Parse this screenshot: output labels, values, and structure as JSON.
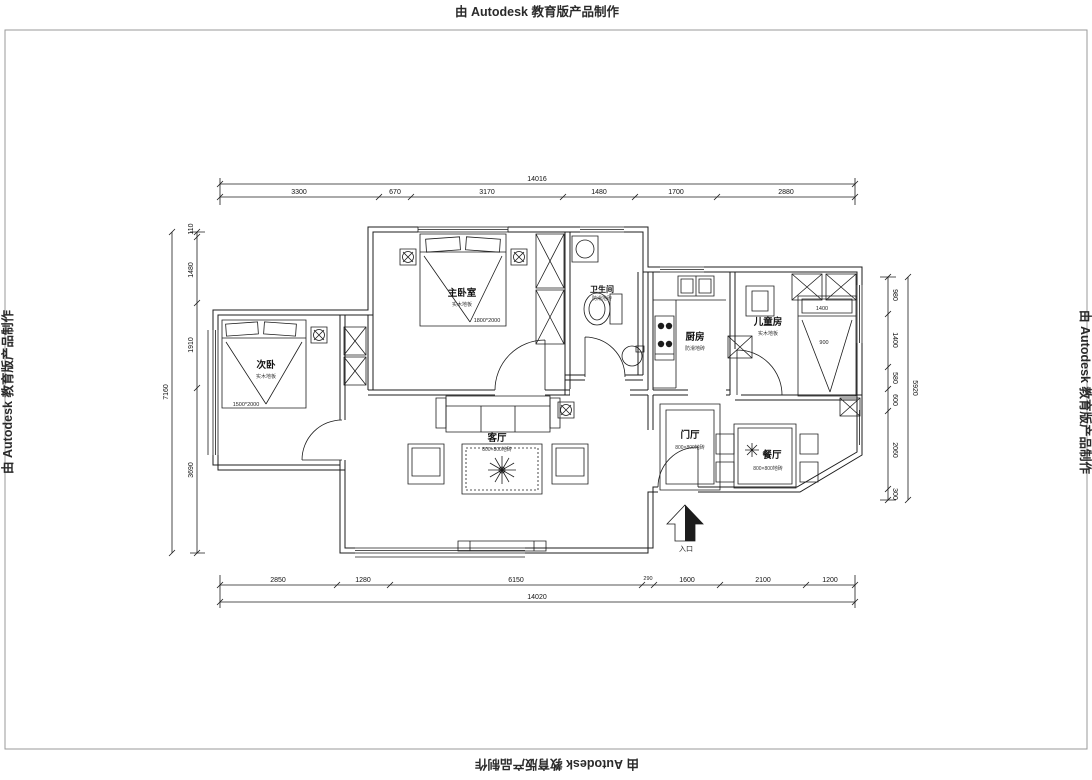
{
  "watermarks": {
    "top": "由 Autodesk 教育版产品制作",
    "bottom": "由 Autodesk 教育版产品制作",
    "left": "由 Autodesk 教育版产品制作",
    "right": "由 Autodesk 教育版产品制作"
  },
  "rooms": {
    "master": {
      "label": "主卧室",
      "note": "实木地板"
    },
    "second": {
      "label": "次卧",
      "note": "实木地板"
    },
    "bath": {
      "label": "卫生间",
      "note": "防滑地砖"
    },
    "kitchen": {
      "label": "厨房",
      "note": "防滑地砖"
    },
    "kids": {
      "label": "儿童房",
      "note": "实木地板"
    },
    "living": {
      "label": "客厅",
      "note": "800×800地砖"
    },
    "hall": {
      "label": "门厅",
      "note": "800×800地砖"
    },
    "dining": {
      "label": "餐厅",
      "note": "800×800地砖"
    },
    "entry": {
      "label": "入口"
    }
  },
  "annotations": {
    "master_bed_size": "1800*2000",
    "second_bed_size": "1500*2000",
    "kids_bed_width": "1400",
    "kids_bed_depth": "900"
  },
  "dimensions": {
    "top": {
      "total": "14016",
      "segments": [
        "3300",
        "670",
        "3170",
        "1480",
        "1700",
        "2880"
      ]
    },
    "bottom": {
      "total": "14020",
      "segments": [
        "2850",
        "1280",
        "6150",
        "290",
        "1600",
        "2100",
        "1200"
      ]
    },
    "left": {
      "total": "7160",
      "segments": [
        "110",
        "1480",
        "1910",
        "3690"
      ]
    },
    "right": {
      "total": "5920",
      "segments": [
        "980",
        "1400",
        "580",
        "600",
        "2060",
        "300"
      ]
    }
  }
}
